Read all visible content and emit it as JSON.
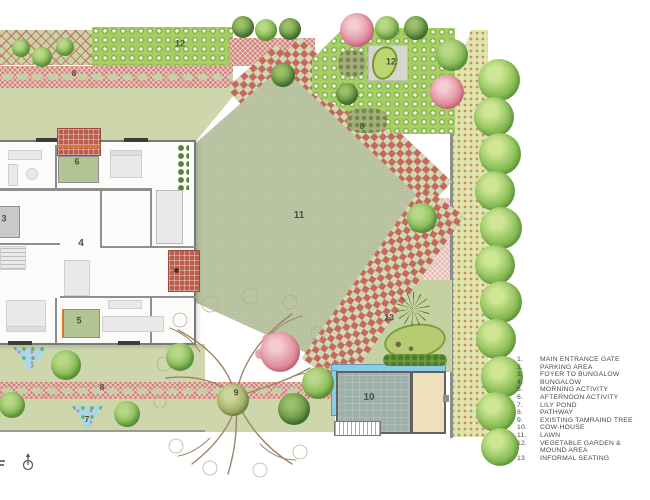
{
  "title": "Bungalow garden landscape site plan",
  "legend": {
    "items": [
      {
        "no": "1.",
        "label": "MAIN ENTRANCE GATE"
      },
      {
        "no": "2.",
        "label": "PARKING AREA"
      },
      {
        "no": "3.",
        "label": "FOYER TO BUNGALOW"
      },
      {
        "no": "4.",
        "label": "BUNGALOW"
      },
      {
        "no": "5.",
        "label": "MORNING ACTIVITY"
      },
      {
        "no": "6.",
        "label": "AFTERNOON ACTIVITY"
      },
      {
        "no": "7.",
        "label": "LILY POND"
      },
      {
        "no": "8.",
        "label": "PATHWAY"
      },
      {
        "no": "9.",
        "label": "EXISTING TAMRAIND TREE"
      },
      {
        "no": "10.",
        "label": "COW-HOUSE"
      },
      {
        "no": "11.",
        "label": "LAWN"
      },
      {
        "no": "12.",
        "label": "VEGETABLE GARDEN &"
      },
      {
        "no": "",
        "label": "MOUND AREA"
      },
      {
        "no": "13",
        "label": "INFORMAL SEATING"
      }
    ]
  },
  "plan": {
    "labels": [
      {
        "t": "12",
        "x": 180,
        "y": 44,
        "s": 9
      },
      {
        "t": "8",
        "x": 74,
        "y": 73,
        "s": 8.5
      },
      {
        "t": "12",
        "x": 391,
        "y": 62,
        "s": 9
      },
      {
        "t": "8",
        "x": 362,
        "y": 126,
        "s": 8.5
      },
      {
        "t": "11",
        "x": 299,
        "y": 216,
        "s": 10
      },
      {
        "t": "13",
        "x": 389,
        "y": 318,
        "s": 9
      },
      {
        "t": "6",
        "x": 77,
        "y": 162,
        "s": 9
      },
      {
        "t": "3",
        "x": 4,
        "y": 219,
        "s": 9
      },
      {
        "t": "4",
        "x": 81,
        "y": 244,
        "s": 10
      },
      {
        "t": "5",
        "x": 79,
        "y": 321,
        "s": 9
      },
      {
        "t": "8",
        "x": 102,
        "y": 387,
        "s": 8.5
      },
      {
        "t": "9",
        "x": 236,
        "y": 393,
        "s": 9
      },
      {
        "t": "7",
        "x": 87,
        "y": 419,
        "s": 8.5
      },
      {
        "t": "10",
        "x": 369,
        "y": 398,
        "s": 10
      }
    ],
    "trees": [
      [
        21,
        48,
        9,
        "g"
      ],
      [
        42,
        57,
        10,
        "g"
      ],
      [
        65,
        47,
        9,
        "g"
      ],
      [
        243,
        27,
        11,
        "d"
      ],
      [
        266,
        30,
        11,
        "g"
      ],
      [
        290,
        29,
        11,
        "d"
      ],
      [
        387,
        28,
        12,
        "g"
      ],
      [
        416,
        28,
        12,
        "d"
      ],
      [
        452,
        55,
        16,
        "g"
      ],
      [
        357,
        30,
        17,
        "p"
      ],
      [
        447,
        92,
        17,
        "p"
      ],
      [
        283,
        75,
        12,
        "d"
      ],
      [
        347,
        94,
        11,
        "d"
      ],
      [
        422,
        218,
        15,
        "g"
      ],
      [
        66,
        365,
        15,
        "g"
      ],
      [
        180,
        357,
        14,
        "g"
      ],
      [
        12,
        405,
        13,
        "g"
      ],
      [
        127,
        414,
        13,
        "g"
      ],
      [
        233,
        400,
        16,
        "o"
      ],
      [
        294,
        409,
        16,
        "d"
      ],
      [
        318,
        383,
        16,
        "g"
      ],
      [
        280,
        352,
        20,
        "p"
      ],
      [
        499,
        80,
        21,
        "b"
      ],
      [
        494,
        117,
        20,
        "b"
      ],
      [
        500,
        154,
        21,
        "b"
      ],
      [
        495,
        191,
        20,
        "b"
      ],
      [
        501,
        228,
        21,
        "b"
      ],
      [
        495,
        265,
        20,
        "b"
      ],
      [
        501,
        302,
        21,
        "b"
      ],
      [
        496,
        339,
        20,
        "b"
      ],
      [
        502,
        377,
        21,
        "b"
      ],
      [
        496,
        412,
        20,
        "b"
      ],
      [
        500,
        447,
        19,
        "b"
      ]
    ],
    "colors": {
      "lawn": "#b6c19e",
      "pathway_red": "#cf8276",
      "bed_sage": "#cdd7ab",
      "bed_dot_olive": "#8d8a4c",
      "veg_green": "#a6cf63",
      "strip_green": "#dde7ad",
      "water_blue": "#a8d8ea",
      "cow_water": "#8ecbe4",
      "sand": "#eedfbd",
      "cowhouse_gray": "#9fb0ac",
      "terrace_brick": "#ba5f50",
      "accent_orange": "#e0761f",
      "label_gray": "#4d4d4d",
      "wall_gray": "#8f8f8f",
      "tree_green": "#85bb55",
      "flower_pink": "#e498a6"
    }
  }
}
